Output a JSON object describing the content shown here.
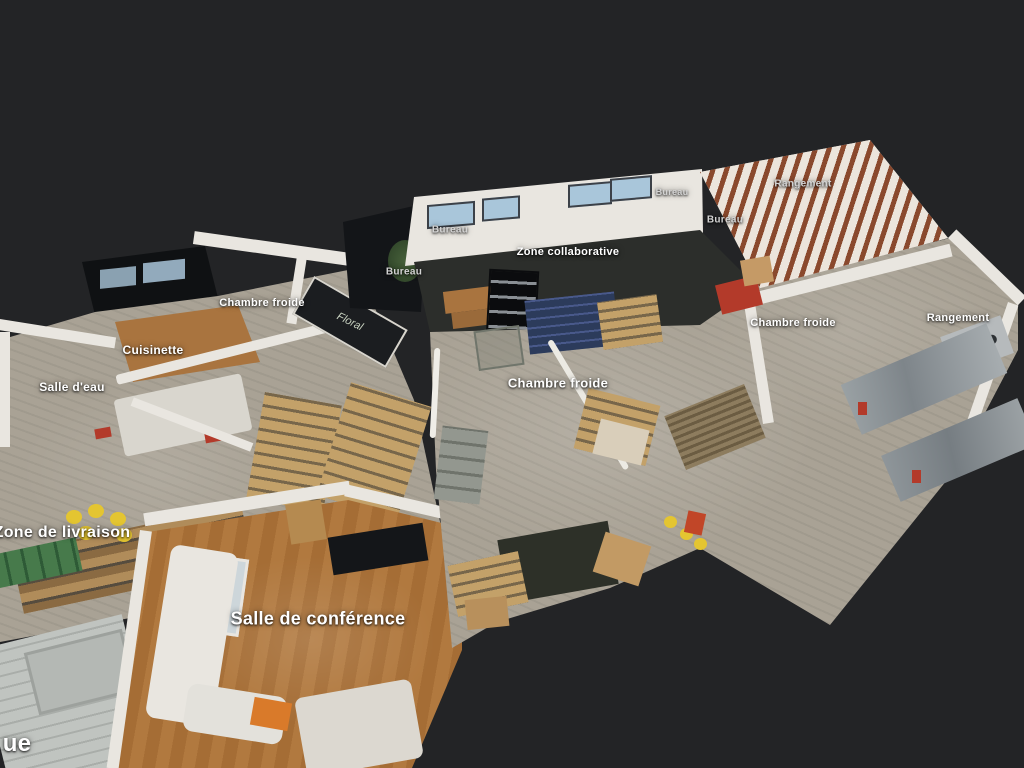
{
  "scene": {
    "app_type": "3d-dollhouse-floorplan-viewer",
    "description": "Top-down angled 3D dollhouse view of a scanned warehouse and office space with labeled rooms",
    "board_text": "Floral"
  },
  "palette": {
    "bg": "#232426",
    "wall": "#e9e6e0",
    "concrete": "#a9a295",
    "carpet": "#2c2e2b",
    "dark-roof": "#0f1113",
    "window-blue": "#a9c6da",
    "wood-kitchen": "#a9743f",
    "wood-conf-a": "#b1793f",
    "wood-conf-b": "#a56d35",
    "pallet": "#c3a169",
    "pallet-gap": "#77664a",
    "yellow": "#e4c531",
    "green": "#477a4b",
    "blue-crate": "#2c3b5b",
    "blue-crate-light": "#49598b",
    "steel": "#9aa1a4",
    "red-accent": "#b33a2a",
    "garage": "#c0c4c0",
    "label": "#ffffff"
  },
  "labels": [
    {
      "id": "bureau-top",
      "text": "Bureau",
      "x": 450,
      "y": 230,
      "size": 10,
      "dim": true
    },
    {
      "id": "bureau-left",
      "text": "Bureau",
      "x": 404,
      "y": 272,
      "size": 10,
      "dim": true
    },
    {
      "id": "zone-collaborative",
      "text": "Zone collaborative",
      "x": 568,
      "y": 252,
      "size": 11,
      "dim": false
    },
    {
      "id": "bureau-right-top",
      "text": "Bureau",
      "x": 672,
      "y": 192,
      "size": 9,
      "dim": true
    },
    {
      "id": "bureau-right",
      "text": "Bureau",
      "x": 725,
      "y": 220,
      "size": 10,
      "dim": true
    },
    {
      "id": "rangement-top",
      "text": "Rangement",
      "x": 803,
      "y": 184,
      "size": 10,
      "dim": true
    },
    {
      "id": "chambre-froide-left",
      "text": "Chambre froide",
      "x": 262,
      "y": 303,
      "size": 11,
      "dim": false
    },
    {
      "id": "cuisinette",
      "text": "Cuisinette",
      "x": 153,
      "y": 350,
      "size": 12,
      "dim": false
    },
    {
      "id": "salle-deau",
      "text": "Salle d'eau",
      "x": 72,
      "y": 387,
      "size": 12,
      "dim": false
    },
    {
      "id": "chambre-froide-center",
      "text": "Chambre froide",
      "x": 558,
      "y": 383,
      "size": 13,
      "dim": false
    },
    {
      "id": "chambre-froide-right",
      "text": "Chambre froide",
      "x": 793,
      "y": 323,
      "size": 11,
      "dim": false
    },
    {
      "id": "rangement-right",
      "text": "Rangement",
      "x": 958,
      "y": 318,
      "size": 11,
      "dim": false
    },
    {
      "id": "zone-livraison",
      "text": "Zone de livraison",
      "x": 62,
      "y": 533,
      "size": 16,
      "dim": false
    },
    {
      "id": "salle-conference",
      "text": "Salle de conférence",
      "x": 318,
      "y": 619,
      "size": 18,
      "dim": false
    },
    {
      "id": "partial-ue",
      "text": "ue",
      "x": 17,
      "y": 744,
      "size": 24,
      "dim": false
    }
  ]
}
